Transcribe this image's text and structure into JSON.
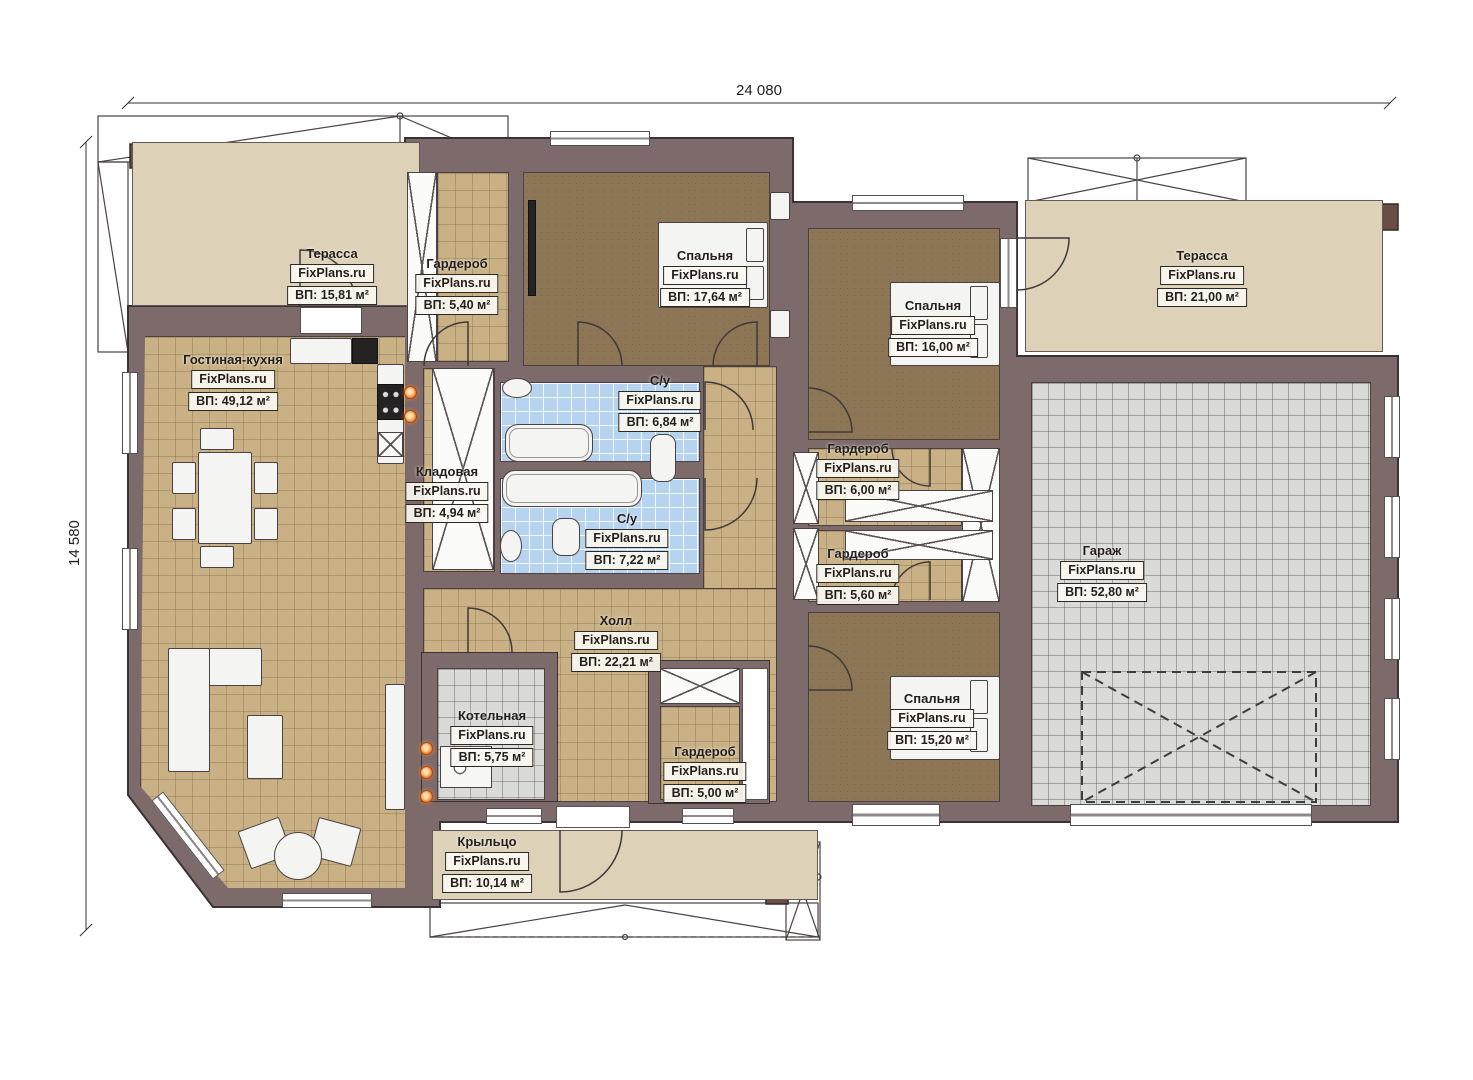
{
  "meta": {
    "brand": "FixPlans.ru"
  },
  "dims": {
    "width": "24 080",
    "height": "14 580"
  },
  "colors": {
    "wall": "#7d6a6b",
    "wall_outline": "#3a3234",
    "floor_tan": "#c9b185",
    "floor_bedroom": "#8d7656",
    "floor_bath": "#b6d4ef",
    "floor_garage": "#dadad8",
    "terrace": "#ddd2b8",
    "flame_accent": "#f58a33"
  },
  "rooms": [
    {
      "key": "terrace_left",
      "name": "Терасса",
      "area": "ВП: 15,81 м²"
    },
    {
      "key": "wardrobe_top",
      "name": "Гардероб",
      "area": "ВП: 5,40 м²"
    },
    {
      "key": "bedroom_1",
      "name": "Спальня",
      "area": "ВП: 17,64 м²"
    },
    {
      "key": "bedroom_2",
      "name": "Спальня",
      "area": "ВП: 16,00 м²"
    },
    {
      "key": "terrace_right",
      "name": "Терасса",
      "area": "ВП: 21,00 м²"
    },
    {
      "key": "living_kitchen",
      "name": "Гостиная-кухня",
      "area": "ВП: 49,12 м²"
    },
    {
      "key": "bath_1",
      "name": "С/у",
      "area": "ВП: 6,84 м²"
    },
    {
      "key": "pantry",
      "name": "Кладовая",
      "area": "ВП: 4,94 м²"
    },
    {
      "key": "bath_2",
      "name": "С/у",
      "area": "ВП: 7,22 м²"
    },
    {
      "key": "wardrobe_r1",
      "name": "Гардероб",
      "area": "ВП: 6,00 м²"
    },
    {
      "key": "wardrobe_r2",
      "name": "Гардероб",
      "area": "ВП: 5,60 м²"
    },
    {
      "key": "garage",
      "name": "Гараж",
      "area": "ВП: 52,80 м²"
    },
    {
      "key": "hall",
      "name": "Холл",
      "area": "ВП: 22,21 м²"
    },
    {
      "key": "boiler",
      "name": "Котельная",
      "area": "ВП: 5,75 м²"
    },
    {
      "key": "wardrobe_hall",
      "name": "Гардероб",
      "area": "ВП: 5,00 м²"
    },
    {
      "key": "bedroom_3",
      "name": "Спальня",
      "area": "ВП: 15,20 м²"
    },
    {
      "key": "porch",
      "name": "Крыльцо",
      "area": "ВП: 10,14 м²"
    }
  ]
}
